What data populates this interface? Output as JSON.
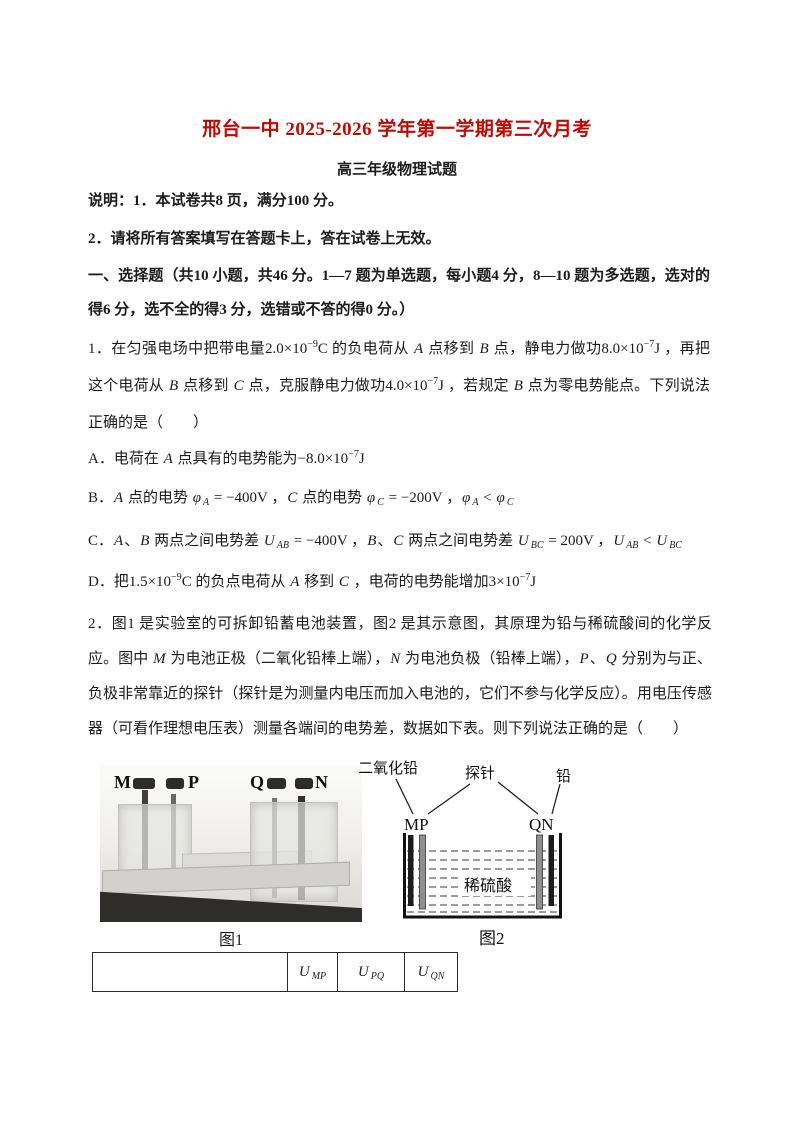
{
  "header": {
    "title": "邢台一中 2025-2026 学年第一学期第三次月考",
    "title_color": "#bb0b04",
    "subtitle": "高三年级物理试题"
  },
  "notes": {
    "line1": "说明：1．本试卷共8 页，满分100 分。",
    "line2": "2．请将所有答案填写在答题卡上，答在试卷上无效。"
  },
  "section": {
    "text": "一、选择题（共10 小题，共46 分。1—7 题为单选题，每小题4 分，8—10 题为多选题，选对的得6 分，选不全的得3 分，选错或不答的得0 分。）"
  },
  "q1": {
    "stem": "1．在匀强电场中把带电量2.0×10^{−9}C 的负电荷从 ~A~ 点移到 ~B~ 点，静电力做功8.0×10^{−7}J ，再把这个电荷从 ~B~ 点移到 ~C~ 点，克服静电力做功4.0×10^{−7}J ，若规定 ~B~ 点为零电势能点。下列说法正确的是（　　）",
    "options": [
      "A．电荷在 ~A~ 点具有的电势能为−8.0×10^{−7}J",
      "B．~A~ 点的电势 ~φ~_{~A~} = −400V ，~C~ 点的电势 ~φ~_{~C~} = −200V ，~φ~_{~A~} < ~φ~_{~C~}",
      "C．~A~、~B~ 两点之间电势差 ~U~_{~AB~} = −400V ，~B~、~C~ 两点之间电势差 ~U~_{~BC~} = 200V ，~U~_{~AB~} < ~U~_{~BC~}",
      "D．把1.5×10^{−9}C 的负点电荷从 ~A~ 移到 ~C~ ，电荷的电势能增加3×10^{−7}J"
    ]
  },
  "q2": {
    "stem": "2．图1 是实验室的可拆卸铅蓄电池装置，图2 是其示意图，其原理为铅与稀硫酸间的化学反应。图中 ~M~ 为电池正极（二氧化铅棒上端），~N~ 为电池负极（铅棒上端），~P~、~Q~ 分别为与正、负极非常靠近的探针（探针是为测量内电压而加入电池的，它们不参与化学反应）。用电压传感器（可看作理想电压表）测量各端间的电势差，数据如下表。则下列说法正确的是（　　）"
  },
  "fig1": {
    "labels": {
      "m": "M",
      "p": "P",
      "q": "Q",
      "n": "N"
    },
    "caption": "图1"
  },
  "fig2": {
    "labels": {
      "lead_dioxide": "二氧化铅",
      "probe": "探针",
      "lead": "铅",
      "mp": "MP",
      "qn": "QN",
      "acid": "稀硫酸"
    },
    "caption": "图2"
  },
  "table": {
    "headers": [
      "",
      "~U~_{~MP~}",
      "~U~_{~PQ~}",
      "~U~_{~QN~}"
    ]
  }
}
